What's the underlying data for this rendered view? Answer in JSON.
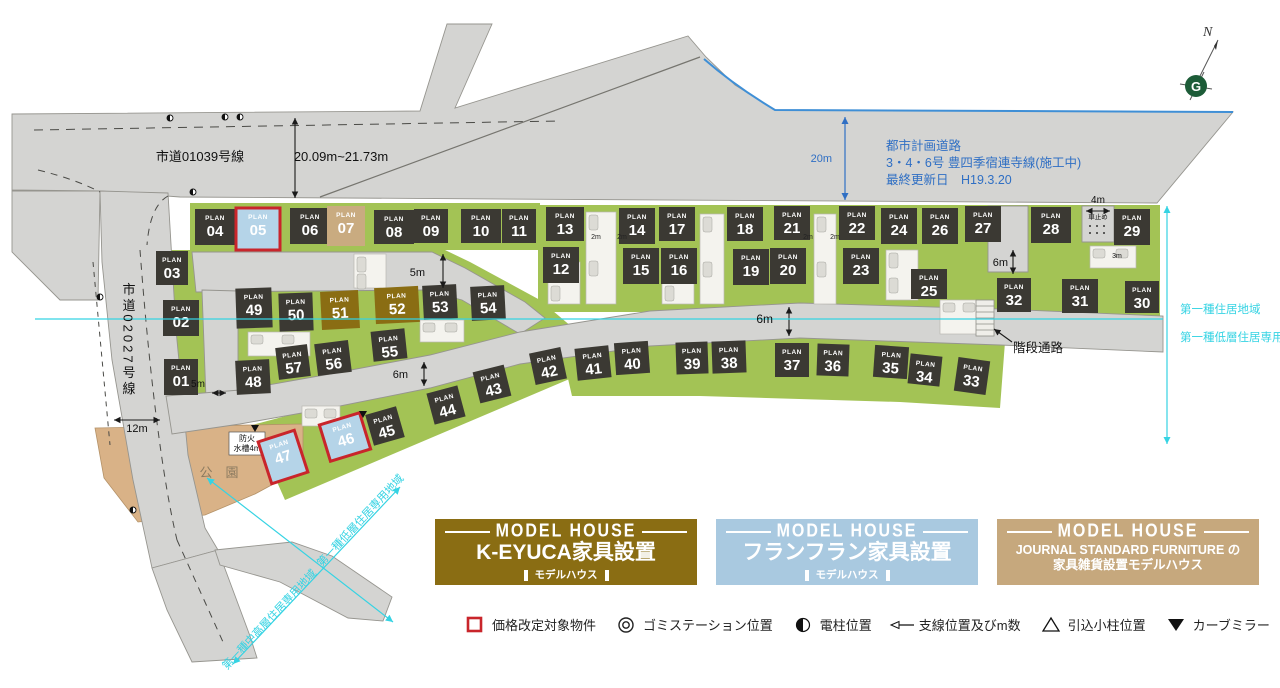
{
  "map": {
    "labels": {
      "road1": "市道01039号線",
      "road1_width": "20.09m~21.73m",
      "road2": "市道02027号線",
      "plan_road_line1": "都市計画道路",
      "plan_road_line2": "3・4・6号 豊四季宿連寺線(施工中)",
      "plan_road_line3": "最終更新日　H19.3.20",
      "w20": "20m",
      "w12": "12m",
      "w5a": "5m",
      "w5b": "5m",
      "w6a": "6m",
      "w6b": "6m",
      "w6c": "6m",
      "w4": "4m",
      "w3": "3m",
      "w2a": "2m",
      "w2b": "2m",
      "w2c": "2m",
      "w2d": "2m",
      "stair": "階段通路",
      "car_stop": "車止め",
      "park": "公　園",
      "fire1": "防火",
      "fire2": "水槽4m",
      "zone_right_top": "第一種住居地域",
      "zone_right_bottom": "第一種低層住居専用地域",
      "zone_diag_low": "第一種低層住居専用地域",
      "zone_diag_mid": "第一種中高層住居専用地域",
      "north": "N",
      "compass_g": "G",
      "plan_word": "PLAN"
    },
    "poles": [
      [
        170,
        118
      ],
      [
        225,
        117
      ],
      [
        240,
        117
      ],
      [
        193,
        192
      ],
      [
        100,
        297
      ],
      [
        133,
        510
      ]
    ],
    "mirrors": [
      [
        255,
        428
      ],
      [
        363,
        414
      ]
    ]
  },
  "colors": {
    "cyan": "#35d3e3",
    "blue_note": "#2f6fc4",
    "red": "#c9252b",
    "gold": "#8a6d13",
    "lightblue": "#b5d4e8",
    "tan": "#c9ab80",
    "dark": "#3b3933",
    "road": "#d4d4d2",
    "green": "#a3c355",
    "park": "#d9b287"
  },
  "plans": [
    {
      "n": "01",
      "x": 181,
      "y": 377,
      "rot": 0,
      "w": 34,
      "h": 36,
      "t": "d"
    },
    {
      "n": "02",
      "x": 181,
      "y": 318,
      "rot": 0,
      "w": 36,
      "h": 36,
      "t": "d"
    },
    {
      "n": "03",
      "x": 172,
      "y": 268,
      "rot": 0,
      "w": 32,
      "h": 34,
      "t": "d"
    },
    {
      "n": "04",
      "x": 215,
      "y": 227,
      "rot": 0,
      "w": 40,
      "h": 36,
      "t": "d"
    },
    {
      "n": "05",
      "x": 258,
      "y": 229,
      "rot": 0,
      "w": 44,
      "h": 42,
      "t": "b"
    },
    {
      "n": "06",
      "x": 310,
      "y": 226,
      "rot": 0,
      "w": 40,
      "h": 36,
      "t": "d"
    },
    {
      "n": "07",
      "x": 346,
      "y": 226,
      "rot": 0,
      "w": 38,
      "h": 40,
      "t": "t"
    },
    {
      "n": "08",
      "x": 394,
      "y": 227,
      "rot": 0,
      "w": 40,
      "h": 34,
      "t": "d"
    },
    {
      "n": "09",
      "x": 431,
      "y": 226,
      "rot": 0,
      "w": 34,
      "h": 34,
      "t": "d"
    },
    {
      "n": "10",
      "x": 481,
      "y": 226,
      "rot": 0,
      "w": 40,
      "h": 34,
      "t": "d"
    },
    {
      "n": "11",
      "x": 519,
      "y": 226,
      "rot": 0,
      "w": 34,
      "h": 34,
      "t": "d"
    },
    {
      "n": "12",
      "x": 561,
      "y": 265,
      "rot": 0,
      "w": 36,
      "h": 36,
      "t": "d"
    },
    {
      "n": "13",
      "x": 565,
      "y": 224,
      "rot": 0,
      "w": 38,
      "h": 34,
      "t": "d"
    },
    {
      "n": "14",
      "x": 637,
      "y": 226,
      "rot": 0,
      "w": 36,
      "h": 36,
      "t": "d"
    },
    {
      "n": "15",
      "x": 641,
      "y": 266,
      "rot": 0,
      "w": 36,
      "h": 36,
      "t": "d"
    },
    {
      "n": "16",
      "x": 679,
      "y": 266,
      "rot": 0,
      "w": 36,
      "h": 36,
      "t": "d"
    },
    {
      "n": "17",
      "x": 677,
      "y": 224,
      "rot": 0,
      "w": 36,
      "h": 34,
      "t": "d"
    },
    {
      "n": "18",
      "x": 745,
      "y": 224,
      "rot": 0,
      "w": 36,
      "h": 34,
      "t": "d"
    },
    {
      "n": "19",
      "x": 751,
      "y": 267,
      "rot": 0,
      "w": 36,
      "h": 36,
      "t": "d"
    },
    {
      "n": "20",
      "x": 788,
      "y": 266,
      "rot": 0,
      "w": 36,
      "h": 36,
      "t": "d"
    },
    {
      "n": "21",
      "x": 792,
      "y": 223,
      "rot": 0,
      "w": 36,
      "h": 34,
      "t": "d"
    },
    {
      "n": "22",
      "x": 857,
      "y": 223,
      "rot": 0,
      "w": 36,
      "h": 34,
      "t": "d"
    },
    {
      "n": "23",
      "x": 861,
      "y": 266,
      "rot": 0,
      "w": 36,
      "h": 36,
      "t": "d"
    },
    {
      "n": "24",
      "x": 899,
      "y": 226,
      "rot": 0,
      "w": 36,
      "h": 36,
      "t": "d"
    },
    {
      "n": "25",
      "x": 929,
      "y": 284,
      "rot": 0,
      "w": 36,
      "h": 30,
      "t": "d"
    },
    {
      "n": "26",
      "x": 940,
      "y": 226,
      "rot": 0,
      "w": 36,
      "h": 36,
      "t": "d"
    },
    {
      "n": "27",
      "x": 983,
      "y": 224,
      "rot": 0,
      "w": 36,
      "h": 36,
      "t": "d"
    },
    {
      "n": "28",
      "x": 1051,
      "y": 225,
      "rot": 0,
      "w": 40,
      "h": 36,
      "t": "d"
    },
    {
      "n": "29",
      "x": 1132,
      "y": 227,
      "rot": 0,
      "w": 36,
      "h": 36,
      "t": "d"
    },
    {
      "n": "30",
      "x": 1142,
      "y": 297,
      "rot": 0,
      "w": 34,
      "h": 32,
      "t": "d"
    },
    {
      "n": "31",
      "x": 1080,
      "y": 296,
      "rot": 0,
      "w": 36,
      "h": 34,
      "t": "d"
    },
    {
      "n": "32",
      "x": 1014,
      "y": 295,
      "rot": 0,
      "w": 34,
      "h": 34,
      "t": "d"
    },
    {
      "n": "33",
      "x": 972,
      "y": 376,
      "rot": 8,
      "w": 32,
      "h": 34,
      "t": "d"
    },
    {
      "n": "34",
      "x": 925,
      "y": 370,
      "rot": 6,
      "w": 32,
      "h": 30,
      "t": "d"
    },
    {
      "n": "35",
      "x": 891,
      "y": 362,
      "rot": 4,
      "w": 34,
      "h": 32,
      "t": "d"
    },
    {
      "n": "36",
      "x": 833,
      "y": 360,
      "rot": 2,
      "w": 32,
      "h": 32,
      "t": "d"
    },
    {
      "n": "37",
      "x": 792,
      "y": 360,
      "rot": 0,
      "w": 34,
      "h": 34,
      "t": "d"
    },
    {
      "n": "38",
      "x": 729,
      "y": 357,
      "rot": -2,
      "w": 34,
      "h": 32,
      "t": "d"
    },
    {
      "n": "39",
      "x": 692,
      "y": 358,
      "rot": -2,
      "w": 32,
      "h": 32,
      "t": "d"
    },
    {
      "n": "40",
      "x": 632,
      "y": 358,
      "rot": -4,
      "w": 34,
      "h": 32,
      "t": "d"
    },
    {
      "n": "41",
      "x": 593,
      "y": 363,
      "rot": -6,
      "w": 34,
      "h": 32,
      "t": "d"
    },
    {
      "n": "42",
      "x": 548,
      "y": 366,
      "rot": -12,
      "w": 32,
      "h": 32,
      "t": "d"
    },
    {
      "n": "43",
      "x": 492,
      "y": 384,
      "rot": -14,
      "w": 32,
      "h": 32,
      "t": "d"
    },
    {
      "n": "44",
      "x": 446,
      "y": 405,
      "rot": -15,
      "w": 32,
      "h": 32,
      "t": "d"
    },
    {
      "n": "45",
      "x": 385,
      "y": 426,
      "rot": -16,
      "w": 32,
      "h": 32,
      "t": "d"
    },
    {
      "n": "46",
      "x": 345,
      "y": 437,
      "rot": -17,
      "w": 42,
      "h": 38,
      "t": "b"
    },
    {
      "n": "47",
      "x": 283,
      "y": 457,
      "rot": -18,
      "w": 38,
      "h": 44,
      "t": "b"
    },
    {
      "n": "48",
      "x": 253,
      "y": 377,
      "rot": -3,
      "w": 34,
      "h": 34,
      "t": "d"
    },
    {
      "n": "49",
      "x": 254,
      "y": 308,
      "rot": -2,
      "w": 36,
      "h": 40,
      "t": "d"
    },
    {
      "n": "50",
      "x": 296,
      "y": 312,
      "rot": -2,
      "w": 34,
      "h": 38,
      "t": "d"
    },
    {
      "n": "51",
      "x": 340,
      "y": 310,
      "rot": -3,
      "w": 38,
      "h": 38,
      "t": "g"
    },
    {
      "n": "52",
      "x": 397,
      "y": 305,
      "rot": -3,
      "w": 44,
      "h": 36,
      "t": "g"
    },
    {
      "n": "53",
      "x": 440,
      "y": 302,
      "rot": -3,
      "w": 34,
      "h": 34,
      "t": "d"
    },
    {
      "n": "54",
      "x": 488,
      "y": 303,
      "rot": -3,
      "w": 34,
      "h": 34,
      "t": "d"
    },
    {
      "n": "55",
      "x": 389,
      "y": 345,
      "rot": -6,
      "w": 34,
      "h": 30,
      "t": "d"
    },
    {
      "n": "56",
      "x": 333,
      "y": 358,
      "rot": -7,
      "w": 34,
      "h": 32,
      "t": "d"
    },
    {
      "n": "57",
      "x": 293,
      "y": 362,
      "rot": -7,
      "w": 32,
      "h": 32,
      "t": "d"
    }
  ],
  "model_houses": [
    {
      "id": "keyuca",
      "header": "MODEL HOUSE",
      "lines": [
        "K-EYUCA家具設置"
      ],
      "sub": "モデルハウス",
      "bg": "#8a6d13"
    },
    {
      "id": "francfranc",
      "header": "MODEL HOUSE",
      "lines": [
        "フランフラン家具設置"
      ],
      "sub": "モデルハウス",
      "bg": "#a9c9e0"
    },
    {
      "id": "journal-standard",
      "header": "MODEL HOUSE",
      "lines": [
        "JOURNAL STANDARD FURNITURE の",
        "家具雑貨設置モデルハウス"
      ],
      "sub": "",
      "bg": "#c6a87d"
    }
  ],
  "legend": [
    {
      "icon": "price-square",
      "label": "価格改定対象物件"
    },
    {
      "icon": "gomi-station",
      "label": "ゴミステーション位置"
    },
    {
      "icon": "pole",
      "label": "電柱位置"
    },
    {
      "icon": "guy-wire-arrow",
      "label": "支線位置及びm数"
    },
    {
      "icon": "pull-pole",
      "label": "引込小柱位置"
    },
    {
      "icon": "curve-mirror",
      "label": "カーブミラー"
    }
  ]
}
